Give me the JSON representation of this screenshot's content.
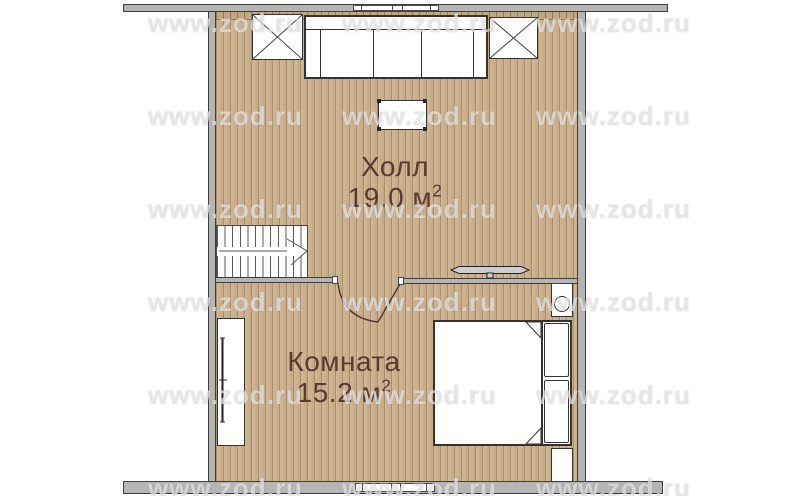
{
  "watermark": {
    "text": "www.zod.ru"
  },
  "rooms": [
    {
      "name": "Холл",
      "area_value": "19.0 м",
      "area_exponent": "2"
    },
    {
      "name": "Комната",
      "area_value": "15.2 м",
      "area_exponent": "2"
    }
  ],
  "colors": {
    "floor": "#cbb192",
    "floor_line": "#a8906d",
    "wall_fill": "#b5b5b5",
    "wall_edge": "#3f3f3f",
    "label_text": "#5b3a2f",
    "furniture_line": "#333333"
  }
}
